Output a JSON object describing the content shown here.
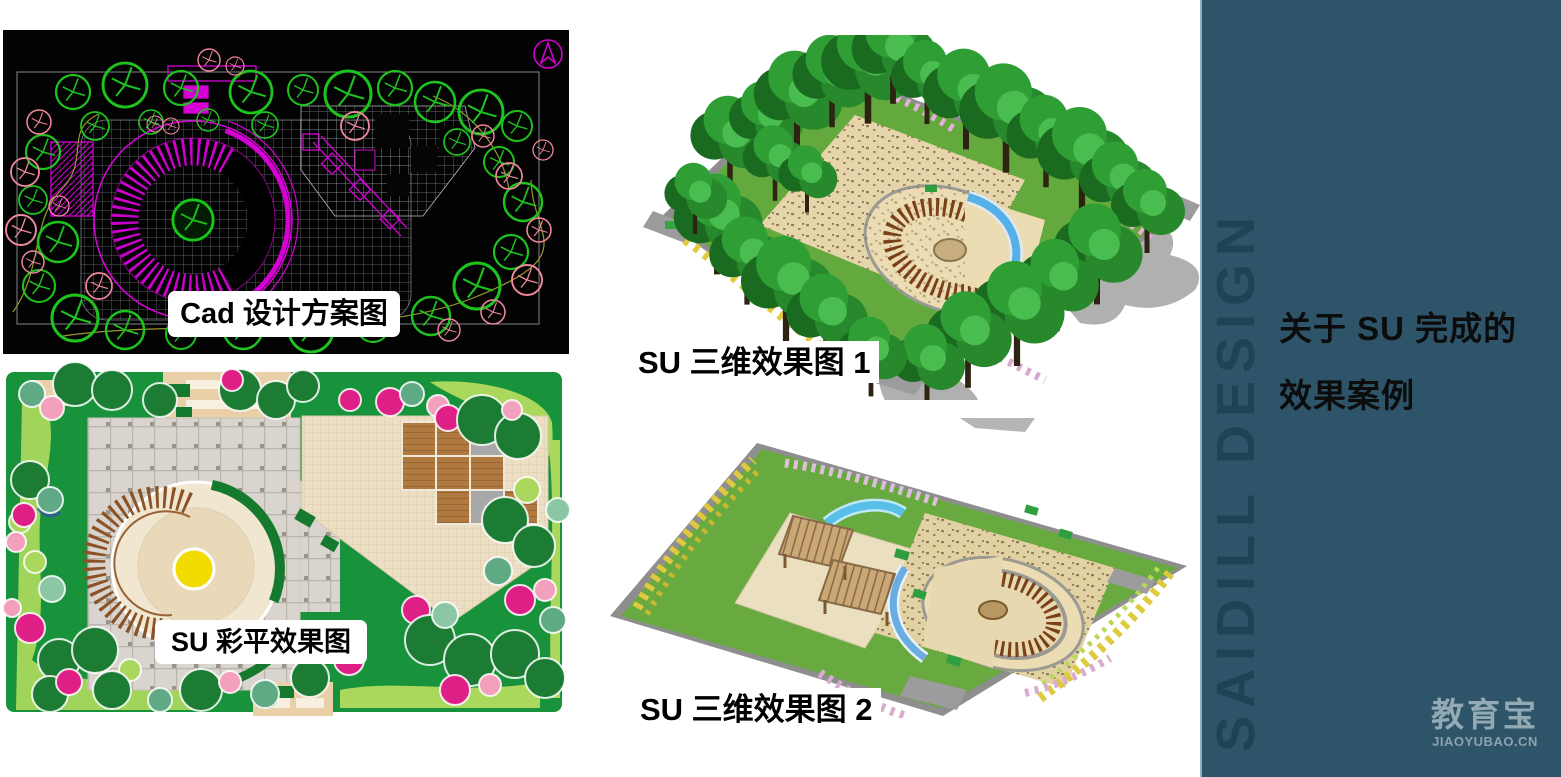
{
  "slide": {
    "background_color": "#ffffff",
    "captions": {
      "cad_plan": "Cad 设计方案图",
      "su_color_plan": "SU 彩平效果图",
      "su_3d_render_1": "SU 三维效果图 1",
      "su_3d_render_2": "SU 三维效果图 2"
    },
    "right_panel": {
      "background_color": "#2D5468",
      "edge_color": "#8FB0BE",
      "title_line1": "关于 SU 完成的",
      "title_line2": "效果案例",
      "title_color": "#0c0c0c",
      "vertical_watermark": "SAIDILL DESIGN",
      "vertical_watermark_color": "#1F4254",
      "brand_watermark": {
        "logo_text": "教育宝",
        "url_text": "JIAOYUBAO.CN",
        "color": "#93A9B4"
      }
    }
  }
}
